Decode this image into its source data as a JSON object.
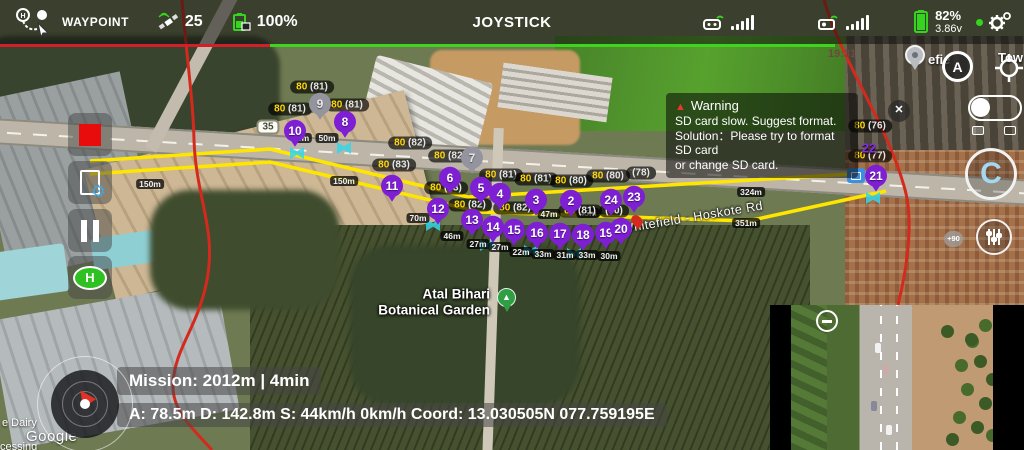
{
  "top_bar": {
    "mode_label": "WAYPOINT",
    "satellite_count": "25",
    "mission_battery": "100%",
    "center_label": "JOYSTICK",
    "battery_percent": "82%",
    "battery_voltage": "3.86v",
    "underline_colors": {
      "left": "#d31f2a",
      "right": "#3fd41f"
    }
  },
  "warning": {
    "title": "Warning",
    "lines": [
      "SD card slow. Suggest format.",
      "Solution：Please try to format SD card",
      "or change SD card."
    ]
  },
  "left_toolbar": {
    "home_label": "H"
  },
  "map": {
    "road_shield": "35",
    "time_label": "19:31",
    "gimbal_pitch": "+90",
    "compass_label": "A",
    "close_label": "✕",
    "recenter_label": "C",
    "poi_line1": "Atal Bihari",
    "poi_line2": "Botanical Garden",
    "poi_icon": "▲",
    "road_name": "Whitefield - Hoskote Rd",
    "place_fragment_left": "efie",
    "place_fragment_right": "Tow",
    "watermark_line1": "e Dairy",
    "watermark_logo": "Google",
    "watermark_line2": "cessing",
    "wp22_label": "22",
    "accent_purple": "#7e1fd4",
    "path_yellow": "#ffe600",
    "fence_red": "#d42a1e",
    "waypoints": [
      {
        "n": "10",
        "x": 295,
        "y": 133
      },
      {
        "n": "8",
        "x": 345,
        "y": 124
      },
      {
        "n": "11",
        "x": 392,
        "y": 188
      },
      {
        "n": "6",
        "x": 450,
        "y": 180
      },
      {
        "n": "5",
        "x": 481,
        "y": 190
      },
      {
        "n": "4",
        "x": 500,
        "y": 196
      },
      {
        "n": "3",
        "x": 536,
        "y": 202
      },
      {
        "n": "2",
        "x": 571,
        "y": 203
      },
      {
        "n": "24",
        "x": 611,
        "y": 202
      },
      {
        "n": "23",
        "x": 634,
        "y": 199
      },
      {
        "n": "12",
        "x": 438,
        "y": 211
      },
      {
        "n": "13",
        "x": 472,
        "y": 222
      },
      {
        "n": "14",
        "x": 493,
        "y": 229
      },
      {
        "n": "15",
        "x": 514,
        "y": 232
      },
      {
        "n": "16",
        "x": 537,
        "y": 235
      },
      {
        "n": "17",
        "x": 560,
        "y": 236
      },
      {
        "n": "18",
        "x": 583,
        "y": 237
      },
      {
        "n": "19",
        "x": 606,
        "y": 235
      },
      {
        "n": "20",
        "x": 621,
        "y": 231
      },
      {
        "n": "21",
        "x": 876,
        "y": 178
      }
    ],
    "ghost_waypoints": [
      {
        "n": "9",
        "x": 320,
        "y": 106
      },
      {
        "n": "7",
        "x": 472,
        "y": 160
      }
    ],
    "alt_labels": [
      {
        "m": "80",
        "a": "(81)",
        "x": 312,
        "y": 87
      },
      {
        "m": "80",
        "a": "(81)",
        "x": 290,
        "y": 109
      },
      {
        "m": "80",
        "a": "(81)",
        "x": 347,
        "y": 105
      },
      {
        "m": "80",
        "a": "(82)",
        "x": 410,
        "y": 143
      },
      {
        "m": "80",
        "a": "(82)",
        "x": 450,
        "y": 156
      },
      {
        "m": "80",
        "a": "(83)",
        "x": 394,
        "y": 165
      },
      {
        "m": "80",
        "a": "(83)",
        "x": 446,
        "y": 188
      },
      {
        "m": "80",
        "a": "(82)",
        "x": 470,
        "y": 205
      },
      {
        "m": "80",
        "a": "(81)",
        "x": 501,
        "y": 175
      },
      {
        "m": "80",
        "a": "(81)",
        "x": 536,
        "y": 179
      },
      {
        "m": "80",
        "a": "(80)",
        "x": 571,
        "y": 181
      },
      {
        "m": "80",
        "a": "(80)",
        "x": 608,
        "y": 176
      },
      {
        "m": "",
        "a": "(78)",
        "x": 641,
        "y": 173
      },
      {
        "m": "80",
        "a": "(82)",
        "x": 515,
        "y": 208
      },
      {
        "m": "80",
        "a": "(81)",
        "x": 580,
        "y": 211
      },
      {
        "m": "",
        "a": "(80)",
        "x": 614,
        "y": 211
      },
      {
        "m": "80",
        "a": "(76)",
        "x": 870,
        "y": 126
      },
      {
        "m": "80",
        "a": "(77)",
        "x": 870,
        "y": 156
      }
    ],
    "dist_labels": [
      {
        "t": "0m",
        "x": 303,
        "y": 138
      },
      {
        "t": "50m",
        "x": 327,
        "y": 138
      },
      {
        "t": "150m",
        "x": 150,
        "y": 184
      },
      {
        "t": "150m",
        "x": 344,
        "y": 181
      },
      {
        "t": "70m",
        "x": 418,
        "y": 218
      },
      {
        "t": "46m",
        "x": 452,
        "y": 236
      },
      {
        "t": "27m",
        "x": 478,
        "y": 244
      },
      {
        "t": "27m",
        "x": 500,
        "y": 247
      },
      {
        "t": "22m",
        "x": 521,
        "y": 252
      },
      {
        "t": "33m",
        "x": 543,
        "y": 254
      },
      {
        "t": "31m",
        "x": 565,
        "y": 255
      },
      {
        "t": "33m",
        "x": 587,
        "y": 255
      },
      {
        "t": "30m",
        "x": 609,
        "y": 256
      },
      {
        "t": "47m",
        "x": 549,
        "y": 214
      },
      {
        "t": "45m",
        "x": 588,
        "y": 213
      },
      {
        "t": "324m",
        "x": 751,
        "y": 192
      },
      {
        "t": "351m",
        "x": 746,
        "y": 223
      }
    ],
    "camera_markers": [
      {
        "x": 297,
        "y": 153
      },
      {
        "x": 344,
        "y": 148
      },
      {
        "x": 433,
        "y": 225
      },
      {
        "x": 487,
        "y": 245
      },
      {
        "x": 531,
        "y": 251
      },
      {
        "x": 574,
        "y": 254
      },
      {
        "x": 873,
        "y": 198
      }
    ]
  },
  "bottom_bar": {
    "mission": "Mission: 2012m | 4min",
    "stats": "A: 78.5m D: 142.8m S: 44km/h  0km/h Coord: 13.030505N 077.759195E"
  }
}
